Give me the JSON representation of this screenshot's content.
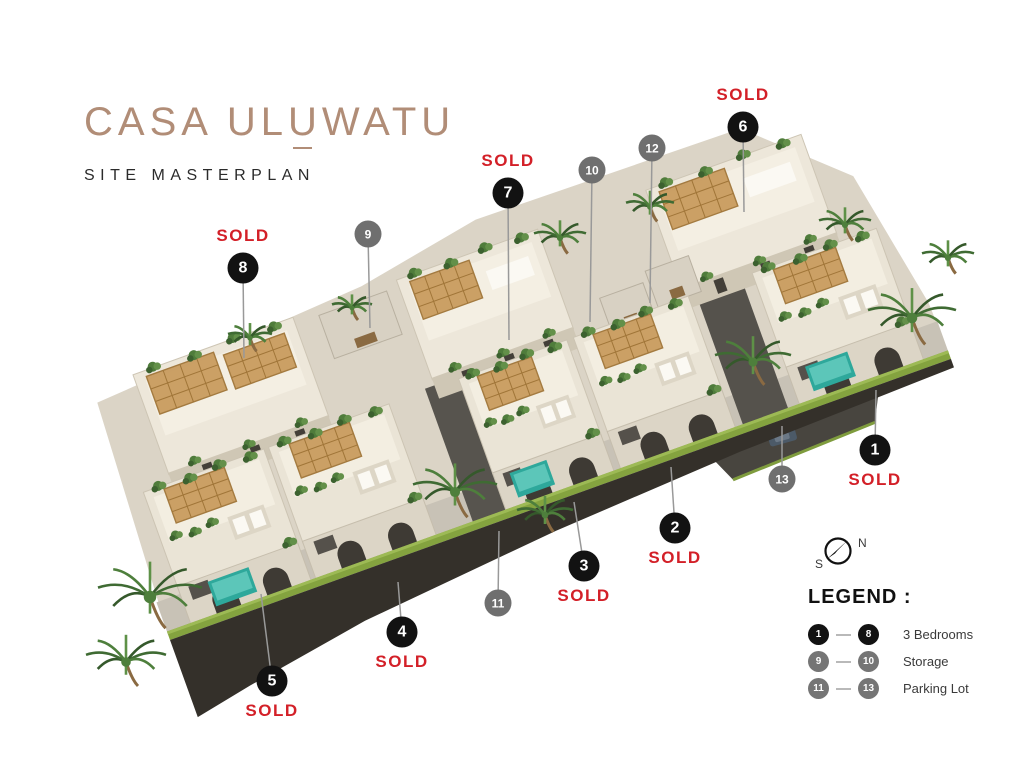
{
  "colors": {
    "sold_red": "#D32028",
    "title_tan": "#B18D77",
    "marker_black": "#121212",
    "marker_gray": "#6F6F6F",
    "legend_gray": "#757575",
    "leader_line": "#999999",
    "pool_teal": "#2EA89B",
    "pergola_wood": "#C99C5F",
    "grass_green": "#84A33F"
  },
  "header": {
    "title_prefix": "CASA UL",
    "title_accent": "U",
    "title_suffix": "WATU",
    "subtitle": "SITE MASTERPLAN"
  },
  "sold_label": "SOLD",
  "markers": [
    {
      "number": "1",
      "variant": "black",
      "x": 875,
      "y": 450,
      "sold": true,
      "sold_pos": "below",
      "line_to": [
        876,
        390
      ]
    },
    {
      "number": "2",
      "variant": "black",
      "x": 675,
      "y": 528,
      "sold": true,
      "sold_pos": "below",
      "line_to": [
        671,
        467
      ]
    },
    {
      "number": "3",
      "variant": "black",
      "x": 584,
      "y": 566,
      "sold": true,
      "sold_pos": "below",
      "line_to": [
        574,
        502
      ]
    },
    {
      "number": "4",
      "variant": "black",
      "x": 402,
      "y": 632,
      "sold": true,
      "sold_pos": "below",
      "line_to": [
        398,
        582
      ]
    },
    {
      "number": "5",
      "variant": "black",
      "x": 272,
      "y": 681,
      "sold": true,
      "sold_pos": "below",
      "line_to": [
        261,
        594
      ]
    },
    {
      "number": "6",
      "variant": "black",
      "x": 743,
      "y": 127,
      "sold": true,
      "sold_pos": "above",
      "line_to": [
        744,
        212
      ]
    },
    {
      "number": "7",
      "variant": "black",
      "x": 508,
      "y": 193,
      "sold": true,
      "sold_pos": "above",
      "line_to": [
        509,
        340
      ]
    },
    {
      "number": "8",
      "variant": "black",
      "x": 243,
      "y": 268,
      "sold": true,
      "sold_pos": "above",
      "line_to": [
        244,
        358
      ]
    },
    {
      "number": "9",
      "variant": "gray",
      "x": 368,
      "y": 234,
      "sold": false,
      "sold_pos": "",
      "line_to": [
        370,
        328
      ]
    },
    {
      "number": "10",
      "variant": "gray",
      "x": 592,
      "y": 170,
      "sold": false,
      "sold_pos": "",
      "line_to": [
        590,
        322
      ]
    },
    {
      "number": "11",
      "variant": "gray",
      "x": 498,
      "y": 603,
      "sold": false,
      "sold_pos": "",
      "line_to": [
        499,
        531
      ]
    },
    {
      "number": "12",
      "variant": "gray",
      "x": 652,
      "y": 148,
      "sold": false,
      "sold_pos": "",
      "line_to": [
        650,
        303
      ]
    },
    {
      "number": "13",
      "variant": "gray",
      "x": 782,
      "y": 479,
      "sold": false,
      "sold_pos": "",
      "line_to": [
        782,
        426
      ]
    }
  ],
  "compass": {
    "north": "N",
    "south": "S"
  },
  "legend": {
    "title": "LEGEND :",
    "items": [
      {
        "from": "1",
        "to": "8",
        "label": "3 Bedrooms",
        "variant": "black"
      },
      {
        "from": "9",
        "to": "10",
        "label": "Storage",
        "variant": "gray"
      },
      {
        "from": "11",
        "to": "13",
        "label": "Parking Lot",
        "variant": "gray"
      }
    ]
  }
}
